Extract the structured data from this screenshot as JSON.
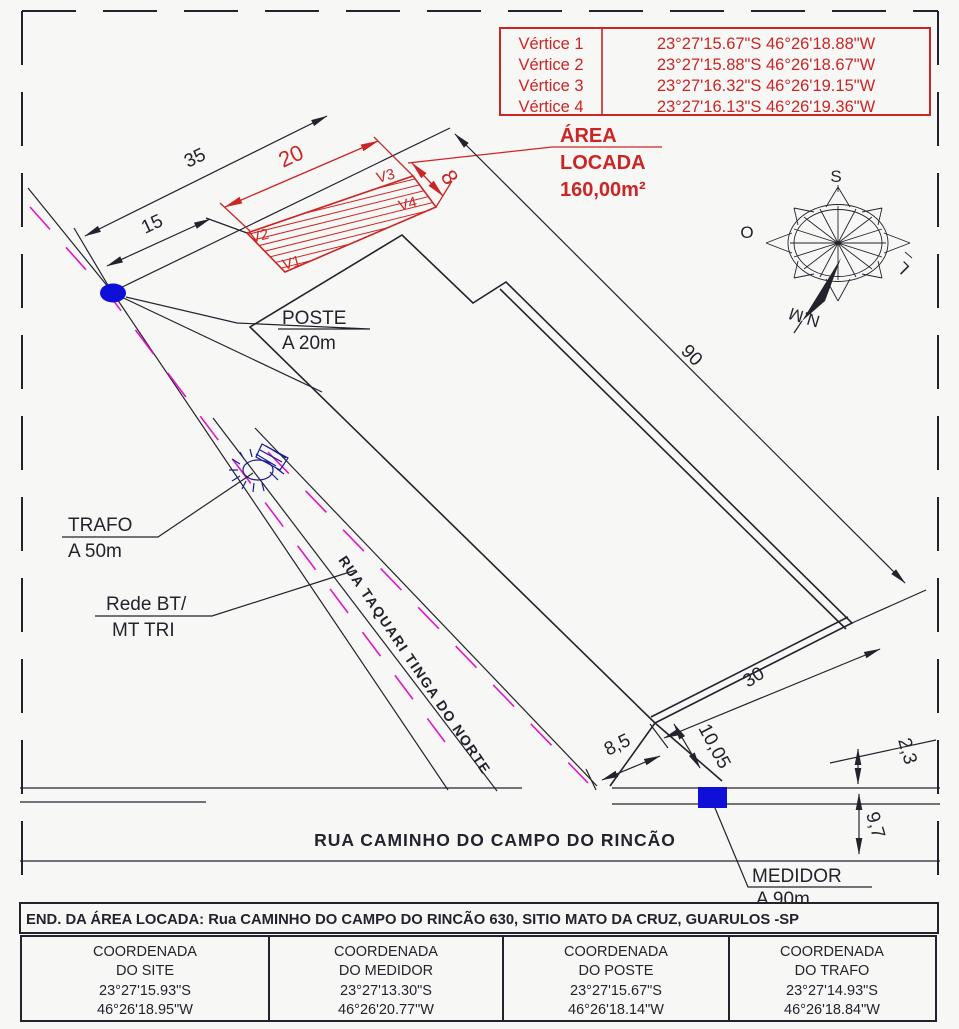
{
  "title": "Planta de localização - área locada",
  "colors": {
    "line": "#23232e",
    "red": "#cb2626",
    "magenta": "#e018c8",
    "blue": "#0f0fd8",
    "navy": "#1a1a96",
    "background": "#f7f7f5"
  },
  "vertex_table": {
    "rows": [
      {
        "label": "Vértice 1",
        "coords": "23°27'15.67\"S 46°26'18.88\"W"
      },
      {
        "label": "Vértice 2",
        "coords": "23°27'15.88\"S 46°26'18.67\"W"
      },
      {
        "label": "Vértice 3",
        "coords": "23°27'16.32\"S 46°26'19.15\"W"
      },
      {
        "label": "Vértice 4",
        "coords": "23°27'16.13\"S 46°26'19.36\"W"
      }
    ]
  },
  "area_label": {
    "line1": "ÁREA",
    "line2": "LOCADA",
    "line3": "160,00m²"
  },
  "dimensions": {
    "d35": "35",
    "d15": "15",
    "d20": "20",
    "d8": "8",
    "d90": "90",
    "d30": "30",
    "d8_5": "8,5",
    "d10_05": "10,05",
    "d2_3": "2,3",
    "d9_7": "9,7"
  },
  "vertices": {
    "v1": "V1",
    "v2": "V2",
    "v3": "V3",
    "v4": "V4"
  },
  "labels": {
    "poste_line1": "POSTE",
    "poste_line2": "A 20m",
    "trafo_line1": "TRAFO",
    "trafo_line2": "A 50m",
    "rede_line1": "Rede BT/",
    "rede_line2": "MT TRI",
    "medidor_line1": "MEDIDOR",
    "medidor_line2": "A 90m",
    "street_diagonal": "RUA TAQUARI TINGA DO NORTE",
    "street_bottom": "RUA CAMINHO DO CAMPO DO RINCÃO"
  },
  "compass": {
    "s": "S",
    "o": "O",
    "l": "L",
    "nm": "N.M"
  },
  "address": "END. DA ÁREA LOCADA: Rua CAMINHO DO CAMPO DO RINCÃO 630, SITIO MATO DA CRUZ, GUARULOS -SP",
  "coord_boxes": [
    {
      "l1": "COORDENADA",
      "l2": "DO SITE",
      "lat": "23°27'15.93\"S",
      "lon": "46°26'18.95\"W"
    },
    {
      "l1": "COORDENADA",
      "l2": "DO MEDIDOR",
      "lat": "23°27'13.30\"S",
      "lon": "46°26'20.77\"W"
    },
    {
      "l1": "COORDENADA",
      "l2": "DO POSTE",
      "lat": "23°27'15.67\"S",
      "lon": "46°26'18.14\"W"
    },
    {
      "l1": "COORDENADA",
      "l2": "DO TRAFO",
      "lat": "23°27'14.93\"S",
      "lon": "46°26'18.84\"W"
    }
  ]
}
